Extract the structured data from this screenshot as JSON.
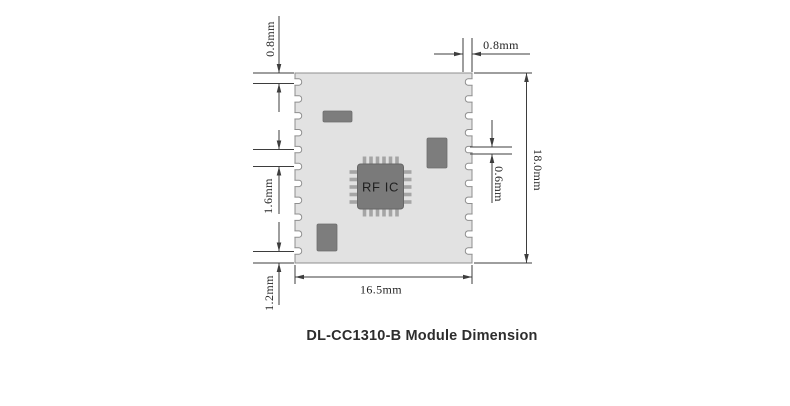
{
  "diagram": {
    "caption": "DL-CC1310-B Module Dimension",
    "module": {
      "width_label": "16.5mm",
      "height_label": "18.0mm",
      "pad_pitch_label": "1.6mm",
      "top_margin_label": "0.8mm",
      "bottom_margin_label": "1.2mm",
      "edge_depth_label": "0.8mm",
      "pad_width_label": "0.6mm",
      "castellations_per_side": 11
    },
    "chip": {
      "label": "RF IC",
      "pins_top": 6,
      "pins_bottom": 6,
      "pins_left": 5,
      "pins_right": 5
    },
    "colors": {
      "line": "#3d3d3d",
      "module_body": "#e2e2e2",
      "component": "#7d7d7d",
      "notch": "#ffffff"
    }
  }
}
